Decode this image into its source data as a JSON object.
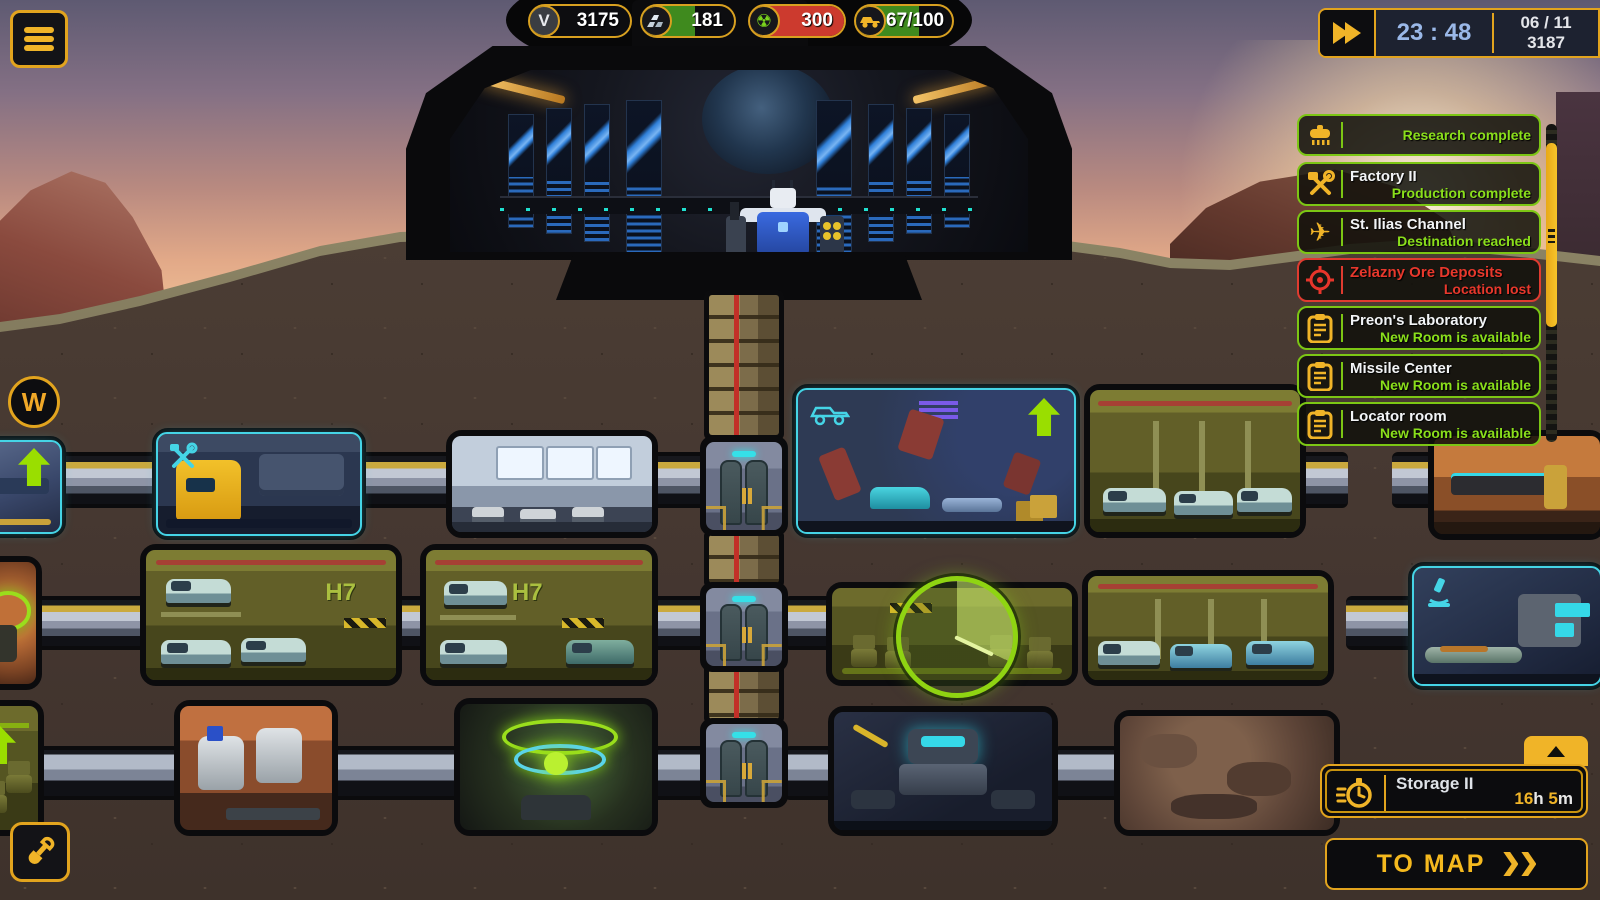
{
  "hud": {
    "resources": [
      {
        "name": "credits",
        "glyph": "V",
        "value": "3175"
      },
      {
        "name": "ingots",
        "value": "181"
      },
      {
        "name": "uranium",
        "value": "300"
      },
      {
        "name": "vehicles",
        "value": "67/100"
      }
    ],
    "time": "23 : 48",
    "date_line1": "06 / 11",
    "date_line2": "3187",
    "waypoint": "W",
    "radiation_glyph": "☢",
    "plane_glyph": "✈"
  },
  "notifications": [
    {
      "title": "",
      "subtitle": "Research complete"
    },
    {
      "title": "Factory II",
      "subtitle": "Production complete"
    },
    {
      "title": "St. Ilias Channel",
      "subtitle": "Destination reached"
    },
    {
      "title": "Zelazny Ore Deposits",
      "subtitle": "Location lost"
    },
    {
      "title": "Preon's Laboratory",
      "subtitle": "New Room is available"
    },
    {
      "title": "Missile Center",
      "subtitle": "New Room is available"
    },
    {
      "title": "Locator room",
      "subtitle": "New Room is available"
    }
  ],
  "build_queue": {
    "title": "Storage II",
    "hours": "16",
    "hours_unit": "h",
    "minutes": "5",
    "minutes_unit": "m"
  },
  "map_button_label": "TO MAP",
  "rooms": {
    "h7_label": "H7"
  },
  "colors": {
    "accent": "#f0b428",
    "ok": "#8adf1b",
    "danger": "#e8352b",
    "cyan": "#45d4e6"
  }
}
